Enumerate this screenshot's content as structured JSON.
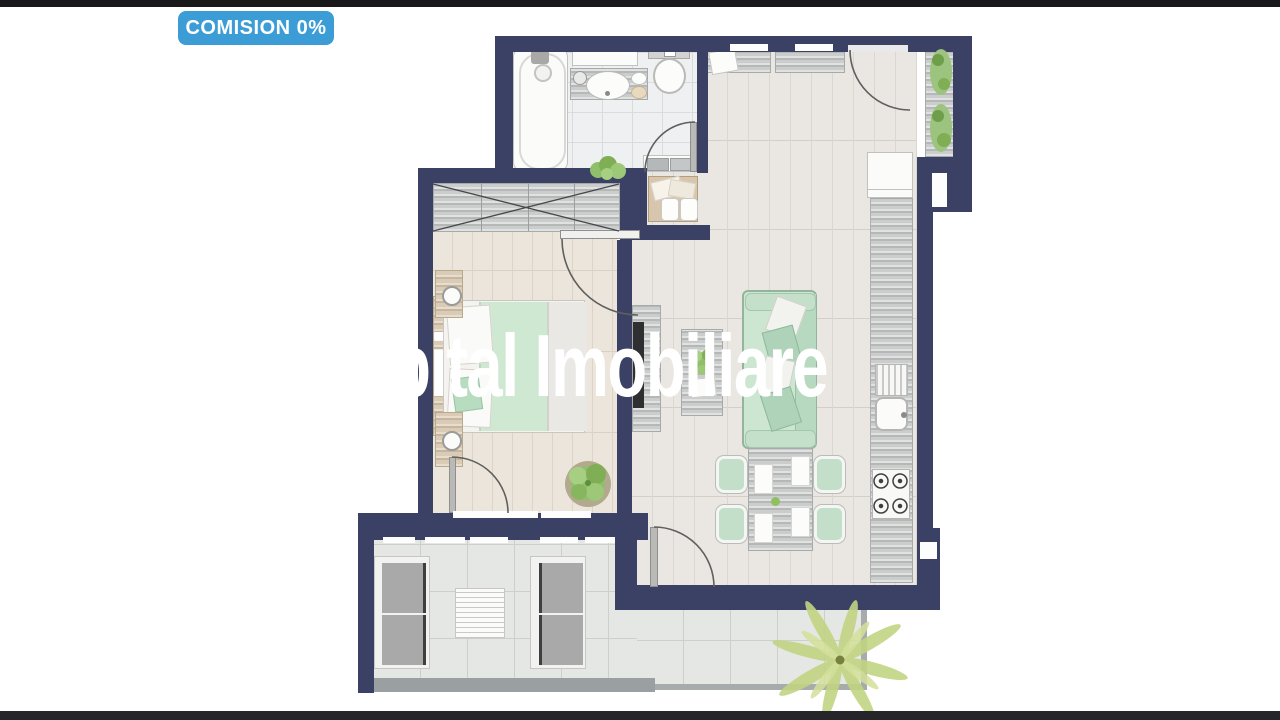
{
  "badge": {
    "label": "COMISION 0%",
    "background": "#3b9cd6",
    "text_color": "#ffffff"
  },
  "watermark": {
    "text": "Capital Imobiliare",
    "color": "#ffffff"
  },
  "colors": {
    "top_bar": "#19191b",
    "bottom_bar": "#25252a",
    "badge": "#3b9cd6",
    "watermark": "#ffffff",
    "wall": "#3b4164",
    "sofa_green": "#cde6d2",
    "sofa_green_dark": "#b7d9bf",
    "bed_green": "#cfe8d2",
    "chair_green": "#c3dfc9",
    "plant_green": "#8fbf6a",
    "palm_green": "#c2d483",
    "railing": "#9aa0a2",
    "cushion_grey": "#a9a9a9",
    "frame_white": "#f2f2f0",
    "tv_black": "#2f2f31",
    "arc_stroke": "#5f5f5f"
  }
}
